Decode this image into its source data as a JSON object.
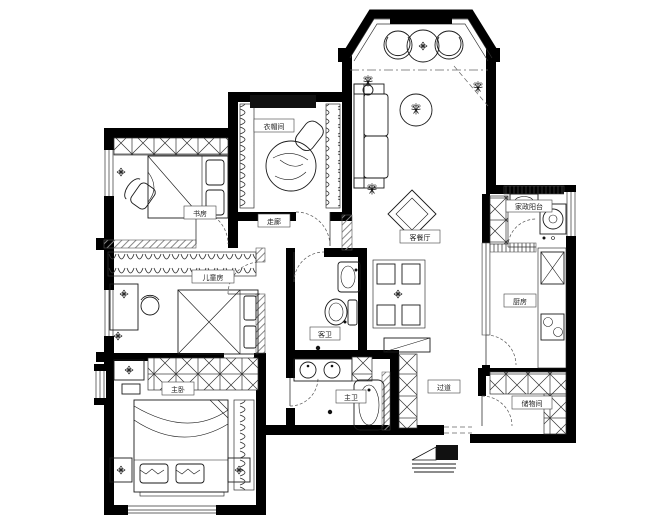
{
  "title": "residential-floor-plan",
  "colors": {
    "wall": "#000000",
    "line": "#1a1a1a",
    "partition_hatch": "#888888",
    "background": "#ffffff"
  },
  "rooms": {
    "cloakroom": {
      "label": "衣帽间"
    },
    "corridor": {
      "label": "走廊"
    },
    "study": {
      "label": "书房"
    },
    "kids_room": {
      "label": "儿童房"
    },
    "master_bedroom": {
      "label": "主卧"
    },
    "guest_bath": {
      "label": "客卫"
    },
    "master_bath": {
      "label": "主卫"
    },
    "living_dining": {
      "label": "客餐厅"
    },
    "utility_balcony": {
      "label": "家政阳台"
    },
    "kitchen": {
      "label": "厨房"
    },
    "storage": {
      "label": "储物间"
    },
    "hallway": {
      "label": "过道"
    }
  }
}
